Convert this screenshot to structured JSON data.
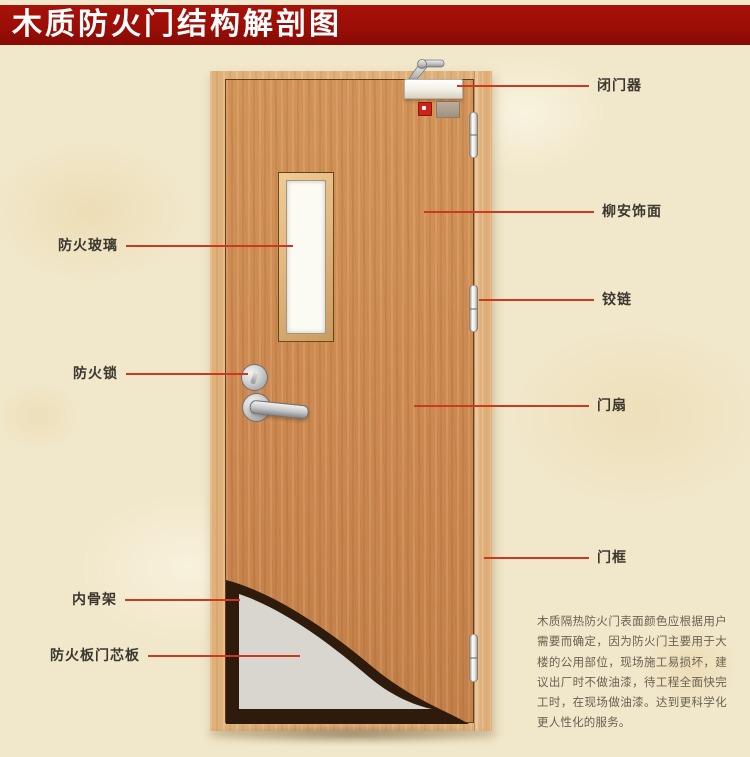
{
  "page": {
    "title": "木质防火门结构解剖图"
  },
  "door": {
    "parts": {
      "door_closer": "闭门器",
      "veneer": "柳安饰面",
      "hinge": "铰链",
      "door_leaf": "门扇",
      "door_frame": "门框",
      "fire_glass": "防火玻璃",
      "fire_lock": "防火锁",
      "inner_skeleton": "内骨架",
      "core_board": "防火板门芯板"
    }
  },
  "description": {
    "text": "木质隔热防火门表面颜色应根据用户需要而确定，因为防火门主要用于大楼的公用部位，现场施工易损坏，建议出厂时不做油漆，待工程全面快完工时，在现场做油漆。达到更科学化更人性化的服务。"
  },
  "colors": {
    "banner_red": "#9c0e07",
    "line_red": "#c93a20",
    "label_color": "#3c3830",
    "desc_color": "#6b6152",
    "bg_parchment": "#f1e7ca",
    "wood_leaf": "#cd8b54",
    "wood_frame": "#dfb07a",
    "skeleton_brown": "#2e1b0b",
    "core_gray": "#d8d6ce",
    "glass_white": "#fbfaf3"
  }
}
